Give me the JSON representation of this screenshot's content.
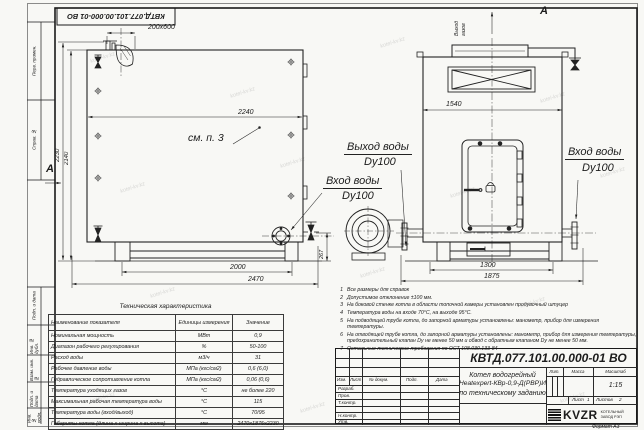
{
  "doc": {
    "designation": "КВТД.077.101.00.000-01 ВО",
    "format_label": "Формат А3"
  },
  "frame": {
    "side_labels": [
      "Перв. примен.",
      "Справ. №",
      "Подп. и дата",
      "Инв. № дубл.",
      "Взам. инв. №",
      "Подп. и дата",
      "Инв. № подл."
    ]
  },
  "views": {
    "front": {
      "flue_dim": "200х600",
      "width_top": "2240",
      "height_outer": "2230",
      "height_inner": "2140",
      "support_span": "2000",
      "length_total": "2470",
      "flange_height": "267",
      "note_ref": "см. п. 3",
      "view_arrow": "А"
    },
    "side": {
      "section_label": "А",
      "gas_out_line1": "Выход",
      "gas_out_line2": "газов",
      "width_top": "1540",
      "support_span": "1300",
      "width_total": "1875"
    },
    "labels": {
      "water_out": "Выход воды",
      "water_out_dn": "Dy100",
      "water_in_mid": "Вход воды",
      "water_in_mid_dn": "Dy100",
      "water_in_right": "Вход воды",
      "water_in_right_dn": "Dy100"
    }
  },
  "notes": {
    "items": [
      {
        "num": "1",
        "text": "Все размеры для справок"
      },
      {
        "num": "2",
        "text": "Допустимое отклонение ±100 мм."
      },
      {
        "num": "3",
        "text": "На боковой стенке котла в области топочной камеры установлен продувочный штуцер"
      },
      {
        "num": "4",
        "text": "Температура воды на входе 70°С, на выходе 95°С."
      },
      {
        "num": "5",
        "text": "На подводящей трубе котла, до запорной арматуры установлены: манометр, прибор для измерения температуры."
      },
      {
        "num": "6",
        "text": "На отводящей трубе котла, до запорной арматуры установлены: манометр, прибор для измерения температуры, предохранительный клапан Dу не менее 50 мм и обвод с обратным клапаном Dу не менее 50 мм."
      },
      {
        "num": "7",
        "text": "Остальные технические требования по ОСТ 108.030.133-84"
      }
    ]
  },
  "table": {
    "title": "Техническая характеристика",
    "headers": [
      "Наименование показателя",
      "Единицы измерения",
      "Значение"
    ],
    "rows": [
      {
        "name": "Номинальная мощность",
        "unit": "МВт",
        "value": "0,9"
      },
      {
        "name": "Диапазон рабочего регулирования",
        "unit": "%",
        "value": "50-100"
      },
      {
        "name": "Расход воды",
        "unit": "м3/ч",
        "value": "31"
      },
      {
        "name": "Рабочее давление воды",
        "unit": "МПа (кгс/см2)",
        "value": "0,6 (6,0)"
      },
      {
        "name": "Гидравлическое сопротивление котла",
        "unit": "МПа (кгс/см2)",
        "value": "0,06 (0,6)"
      },
      {
        "name": "Температура уходящих газов",
        "unit": "°С",
        "value": "не более 220"
      },
      {
        "name": "Максимальная рабочая температура воды",
        "unit": "°С",
        "value": "115"
      },
      {
        "name": "Температура воды (вход/выход)",
        "unit": "°С",
        "value": "70/95"
      },
      {
        "name": "Габариты котла (длина х ширина х высота)",
        "unit": "мм",
        "value": "2470х1875х2230"
      }
    ]
  },
  "titleblock": {
    "designation": "КВТД.077.101.00.000-01 ВО",
    "rev_headers": [
      "Изм.",
      "Лист",
      "№ докум.",
      "Подп.",
      "Дата"
    ],
    "row_labels": [
      "Разраб.",
      "Пров.",
      "Т.контр.",
      "Н.контр.",
      "Утв."
    ],
    "name_line1": "Котел водогрейный",
    "name_line2": "Heatexpert-КВр-0,9-Д(РВР)И",
    "name_line3": "по техническому заданию",
    "lit_label": "Лит.",
    "mass_label": "Масса",
    "scale_label": "Масштаб",
    "scale_value": "1:15",
    "sheet_label": "Лист",
    "sheet_value": "1",
    "sheets_label": "Листов",
    "sheets_value": "2",
    "logo_text": "KVZR",
    "logo_sub1": "КОТЕЛЬНЫЙ",
    "logo_sub2": "ЗАВОД РЭП"
  },
  "watermark": {
    "text": "kotel-kv.kz"
  }
}
